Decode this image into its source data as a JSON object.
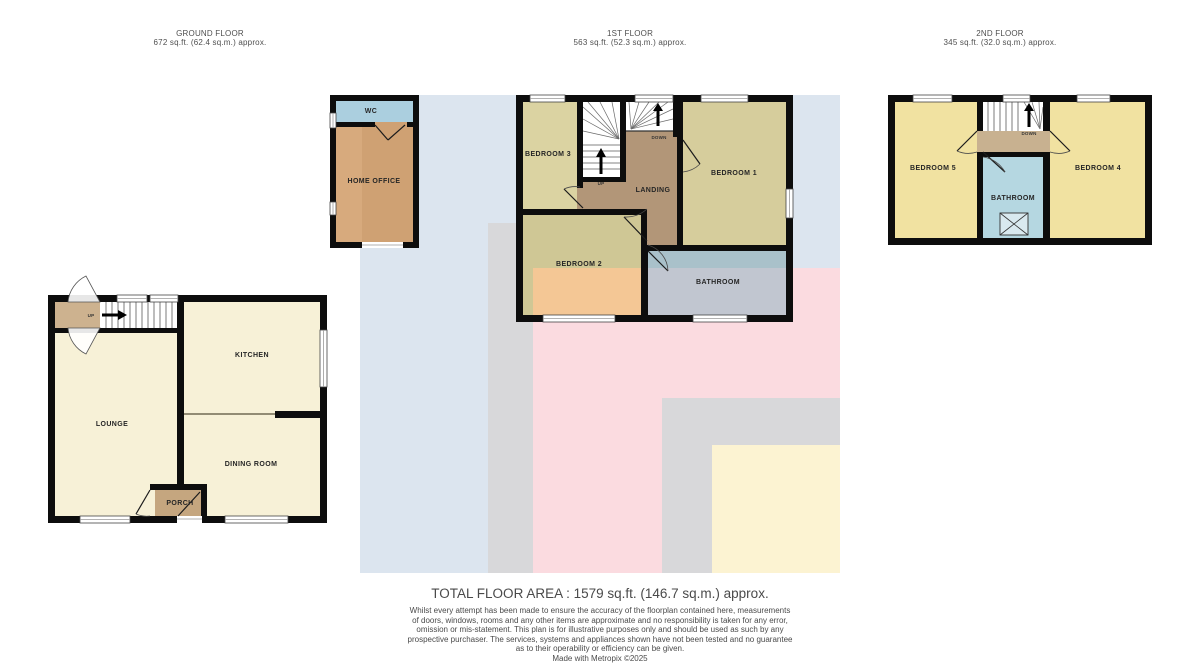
{
  "floors": {
    "ground": {
      "title": "GROUND FLOOR",
      "area": "672 sq.ft. (62.4 sq.m.) approx.",
      "rooms": {
        "lounge": "LOUNGE",
        "kitchen": "KITCHEN",
        "dining": "DINING ROOM",
        "porch": "PORCH",
        "up": "UP"
      },
      "annex": {
        "wc": "WC",
        "home_office": "HOME OFFICE"
      }
    },
    "first": {
      "title": "1ST FLOOR",
      "area": "563 sq.ft. (52.3 sq.m.) approx.",
      "rooms": {
        "bedroom1": "BEDROOM 1",
        "bedroom2": "BEDROOM 2",
        "bedroom3": "BEDROOM 3",
        "landing": "LANDING",
        "bathroom": "BATHROOM",
        "up": "UP",
        "down": "DOWN"
      }
    },
    "second": {
      "title": "2ND FLOOR",
      "area": "345 sq.ft. (32.0 sq.m.) approx.",
      "rooms": {
        "bedroom4": "BEDROOM 4",
        "bedroom5": "BEDROOM 5",
        "bathroom": "BATHROOM",
        "down": "DOWN"
      }
    }
  },
  "footer": {
    "total": "TOTAL FLOOR AREA : 1579 sq.ft. (146.7 sq.m.) approx.",
    "disclaimer": "Whilst every attempt has been made to ensure the accuracy of the floorplan contained here, measurements\nof doors, windows, rooms and any other items are approximate and no responsibility is taken for any error,\nomission or mis-statement. This plan is for illustrative purposes only and should be used as such by any\nprospective purchaser. The services, systems and appliances shown have not been tested and no guarantee\nas to their operability or efficiency can be given.\nMade with Metropix ©2025"
  },
  "colors": {
    "wall": "#0d0d0d",
    "ground_cream": "#f7f1d7",
    "hall_tan": "#cdb28f",
    "porch_tan": "#c5a67f",
    "bedroom1_khaki": "#d6cd9c",
    "bedroom2_khaki": "#cfc795",
    "bedroom3_khaki": "#dbd3a2",
    "bedroom2_overlap_orange": "#f4c795",
    "landing_first": "#b29678",
    "bathroom_first_upper": "#a9c1ca",
    "bathroom_first_lower": "#c1c6d0",
    "second_yellow": "#f1e2a1",
    "landing_second": "#c8b190",
    "bathroom_second": "#b5d7e1",
    "wc_blue": "#abcfdf",
    "home_office_tan": "#d7aa7d",
    "home_office_tan_dark": "#cfa173",
    "bg_blue": "#dce5ef",
    "bg_pink": "#fbdbe0",
    "bg_gray": "#d8d8da",
    "bg_cream": "#fcf3d2"
  }
}
